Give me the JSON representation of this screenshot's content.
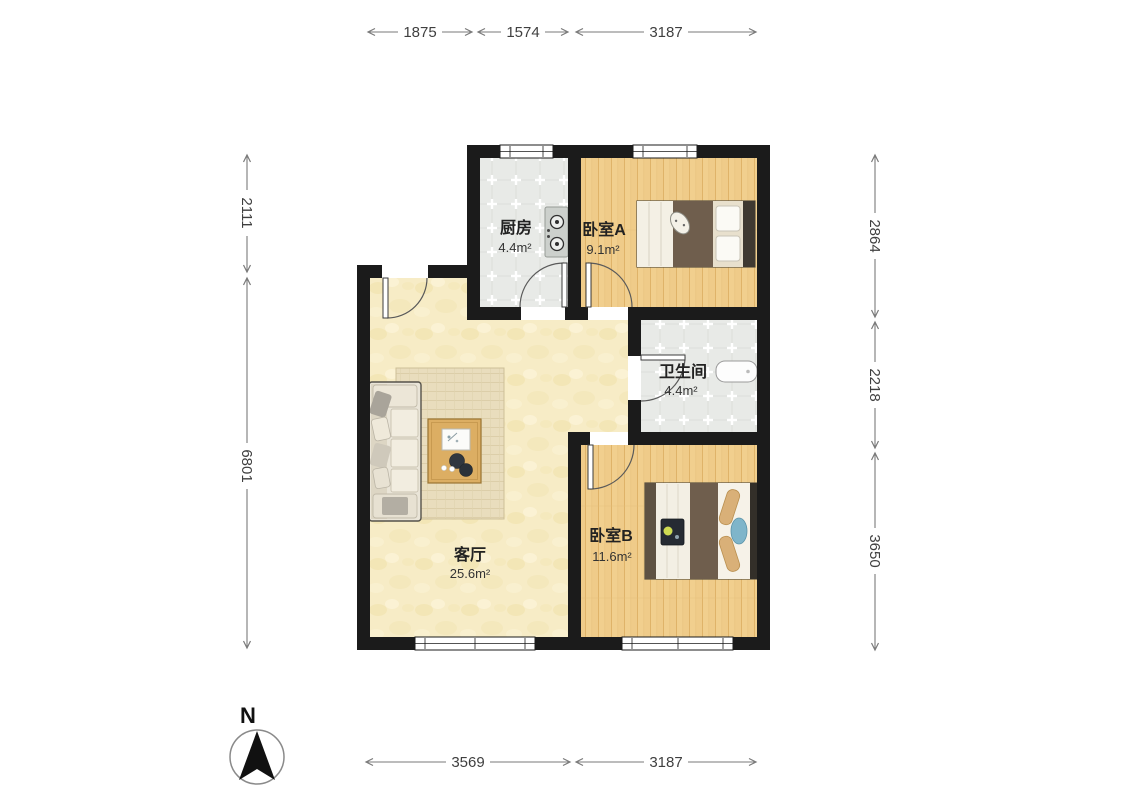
{
  "floorplan": {
    "rooms": {
      "kitchen": {
        "name": "厨房",
        "area": "4.4m²"
      },
      "bedroomA": {
        "name": "卧室A",
        "area": "9.1m²"
      },
      "bathroom": {
        "name": "卫生间",
        "area": "4.4m²"
      },
      "living": {
        "name": "客厅",
        "area": "25.6m²"
      },
      "bedroomB": {
        "name": "卧室B",
        "area": "11.6m²"
      }
    },
    "dimensions": {
      "top": [
        "1875",
        "1574",
        "3187"
      ],
      "left": [
        "2111",
        "6801"
      ],
      "right": [
        "2864",
        "2218",
        "3650"
      ],
      "bottom": [
        "3569",
        "3187"
      ]
    },
    "compass": {
      "label": "N"
    },
    "colors": {
      "wall": "#1b1b1b",
      "wood_floor": "#f1cf8e",
      "tile_floor": "#e8eae7",
      "living_floor": "#f7ecc6"
    }
  }
}
